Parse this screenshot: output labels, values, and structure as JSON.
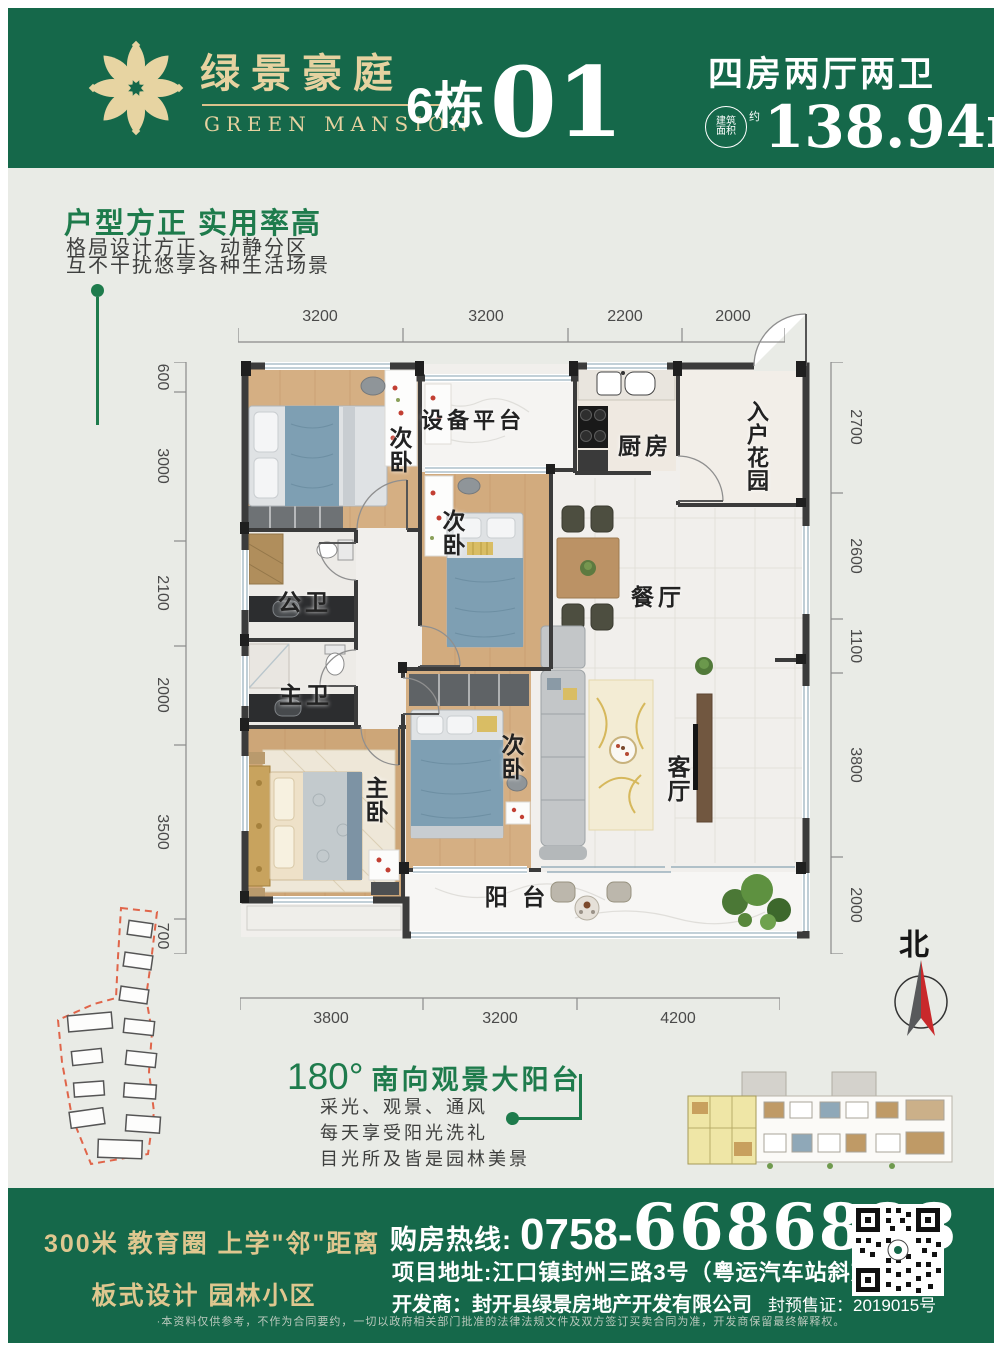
{
  "colors": {
    "brand_green": "#15684A",
    "gold": "#E6D2A0",
    "accent_green": "#1E7B4C",
    "north_red": "#C9292B"
  },
  "header": {
    "brand_cn": "绿景豪庭",
    "brand_en": "GREEN MANSION",
    "building": "6栋",
    "unit": "01",
    "layout": "四房两厅两卫",
    "area_badge_line1": "建筑",
    "area_badge_line2": "面积",
    "area_badge_about": "约",
    "area_value": "138.94m",
    "area_sup": "2"
  },
  "intro": {
    "title": "户型方正 实用率高",
    "line1": "格局设计方正、动静分区",
    "line2": "互不干扰悠享各种生活场景"
  },
  "floorplan": {
    "rooms": {
      "bedroom_top": "次卧",
      "platform": "设备平台",
      "kitchen": "厨房",
      "entry_garden": "入户花园",
      "bedroom_mid": "次卧",
      "dining": "餐厅",
      "bath_public": "公卫",
      "bath_master": "主卫",
      "master_bedroom": "主卧",
      "bedroom_south": "次卧",
      "living": "客厅",
      "balcony": "阳 台"
    },
    "dims_top": [
      "3200",
      "3200",
      "2200",
      "2000"
    ],
    "dims_left": [
      "600",
      "3000",
      "2100",
      "2000",
      "3500",
      "700"
    ],
    "dims_right": [
      "2700",
      "2600",
      "1100",
      "3800",
      "2000"
    ],
    "dims_bottom": [
      "3800",
      "3200",
      "4200"
    ]
  },
  "balcony_callout": {
    "degree": "180°",
    "title": "南向观景大阳台",
    "line1": "采光、观景、通风",
    "line2": "每天享受阳光洗礼",
    "line3": "目光所及皆是园林美景"
  },
  "compass": {
    "label": "北"
  },
  "footer": {
    "slogan1": "300米 教育圈 上学\"邻\"距离",
    "slogan2": "板式设计 园林小区",
    "hotline_label": "购房热线:",
    "hotline_prefix": "0758-",
    "hotline_number": "6686888",
    "address": "项目地址:江口镇封州三路3号（粤运汽车站斜对面）",
    "developer": "开发商：封开县绿景房地产开发有限公司",
    "license": "封预售证：2019015号",
    "disclaimer": "·本资料仅供参考，不作为合同要约，一切以政府相关部门批准的法律法规文件及双方签订买卖合同为准，开发商保留最终解释权。"
  }
}
